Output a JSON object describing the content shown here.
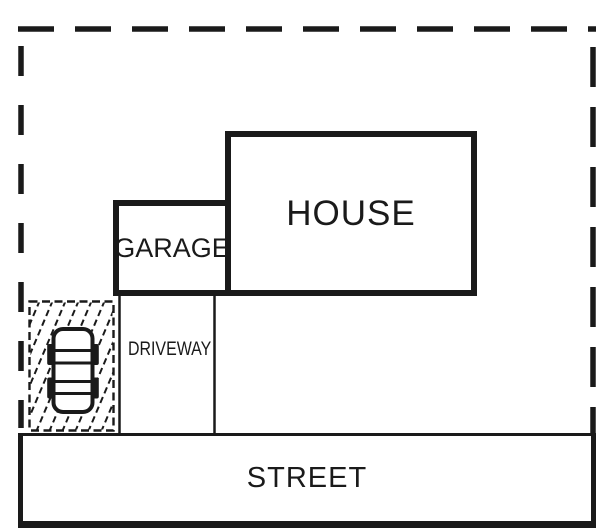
{
  "colors": {
    "ink": "#1a1a1a",
    "paper": "#ffffff"
  },
  "labels": {
    "house": "HOUSE",
    "garage": "GARAGE",
    "driveway": "DRIVEWAY",
    "street": "STREET"
  },
  "icons": {
    "vehicle": "car-top-view-icon"
  },
  "linework": {
    "property_boundary": "dashed",
    "parking_pad_border": "dashed",
    "parking_pad_fill": "diagonal-hatch"
  }
}
